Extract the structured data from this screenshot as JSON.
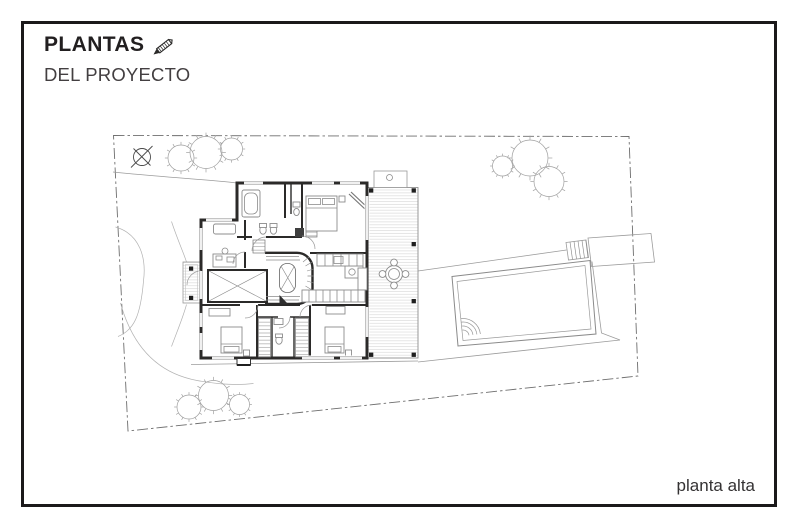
{
  "header": {
    "title": "PLANTAS",
    "subtitle": "DEL PROYECTO",
    "icon": "pencil-icon"
  },
  "footer": {
    "caption": "planta alta"
  },
  "plan": {
    "type": "architectural-floor-plan",
    "floor_label": "planta alta",
    "colors": {
      "frame": "#1b191a",
      "walls": "#2b2a29",
      "furniture": "#8c8c8c",
      "site_lines": "#9b9b9b",
      "boundary": "#6e6e6e",
      "deck_boards": "#cbcbcb",
      "text": "#221f20"
    },
    "elements": [
      "site-boundary",
      "north-arrow",
      "tree-cluster-top-left",
      "tree-cluster-top-right",
      "tree-cluster-bottom",
      "driveway",
      "garden-bed",
      "entry-porch",
      "house-upper-floor",
      "bathroom-tub",
      "bedrooms",
      "kitchen-counters",
      "staircase",
      "double-height-void",
      "wood-deck",
      "outdoor-dining-set",
      "pool",
      "pool-patio",
      "pool-steps",
      "service-structure"
    ]
  }
}
